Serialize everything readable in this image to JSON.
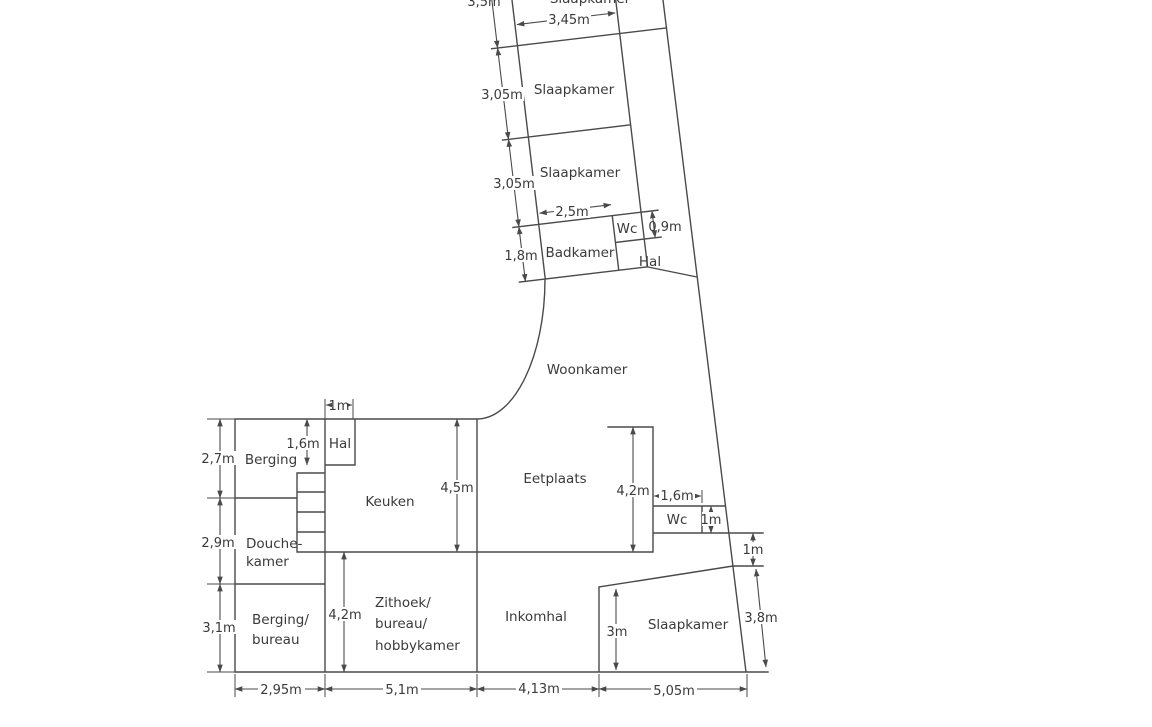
{
  "colors": {
    "background": "#ffffff",
    "line": "#4a4a4a",
    "text": "#3a3a3a"
  },
  "rooms": {
    "slaapkamer_top": "Slaapkamer",
    "slaapkamer_1": "Slaapkamer",
    "slaapkamer_2": "Slaapkamer",
    "badkamer": "Badkamer",
    "wc_upper": "Wc",
    "hal_upper": "Hal",
    "woonkamer": "Woonkamer",
    "hal": "Hal",
    "berging": "Berging",
    "keuken": "Keuken",
    "eetplaats": "Eetplaats",
    "douche_1": "Douche-",
    "douche_2": "kamer",
    "wc_lower": "Wc",
    "berging_bureau_1": "Berging/",
    "berging_bureau_2": "bureau",
    "zithoek_1": "Zithoek/",
    "zithoek_2": "bureau/",
    "zithoek_3": "hobbykamer",
    "inkomhal": "Inkomhal",
    "slaapkamer_3": "Slaapkamer"
  },
  "dims": {
    "top_room_height": "3,5m",
    "top_room_width": "3,45m",
    "s1_height": "3,05m",
    "s2_height": "3,05m",
    "badkamer_width": "2,5m",
    "wc_upper_width": "0,9m",
    "badkamer_height": "1,8m",
    "hal_top_width": "1m",
    "hal_height": "1,6m",
    "berging_height": "2,7m",
    "douche_height": "2,9m",
    "berging_bureau_height": "3,1m",
    "keuken_height": "4,5m",
    "eetplaats_height": "4,2m",
    "wc_lower_width": "1,6m",
    "wc_lower_height": "1m",
    "right_offset": "1m",
    "slaapkamer_right": "3,8m",
    "zithoek_height": "4,2m",
    "slaapkamer_height": "3m",
    "bottom_1": "2,95m",
    "bottom_2": "5,1m",
    "bottom_3": "4,13m",
    "bottom_4": "5,05m"
  }
}
